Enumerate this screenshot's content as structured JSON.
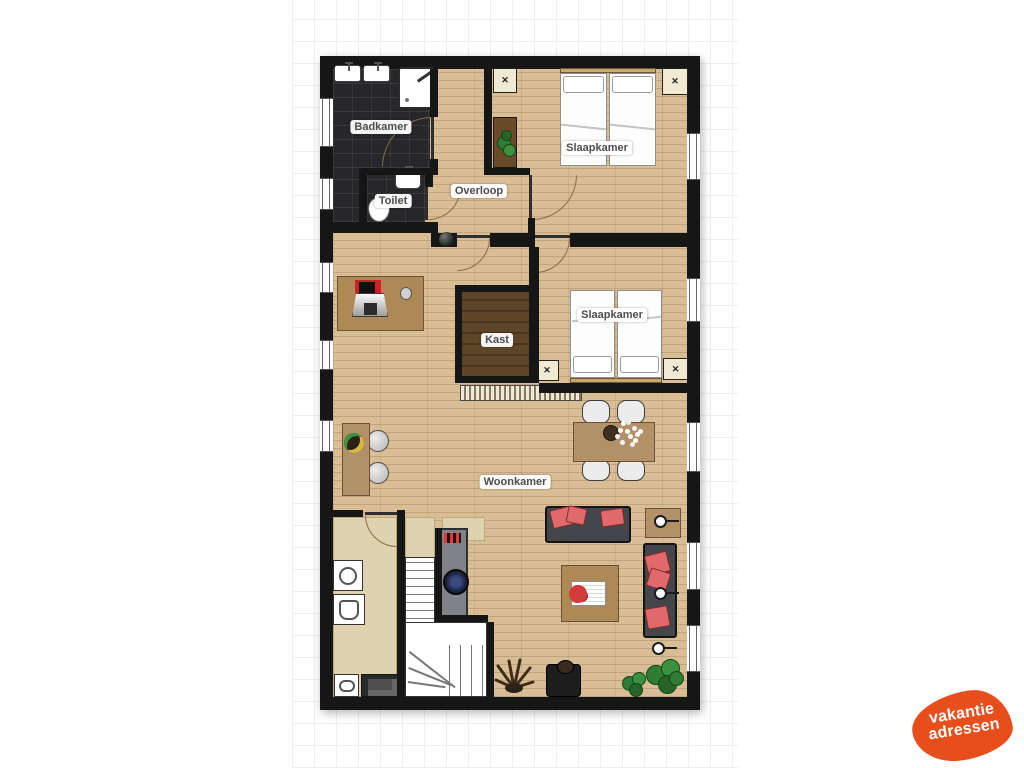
{
  "plan": {
    "type": "floorplan",
    "rooms": {
      "badkamer": "Badkamer",
      "toilet": "Toilet",
      "overloop": "Overloop",
      "slaapkamer_boven": "Slaapkamer",
      "slaapkamer_midden": "Slaapkamer",
      "kast": "Kast",
      "woonkamer": "Woonkamer"
    }
  },
  "logo": {
    "line1": "vakantie",
    "line2": "adressen",
    "bg_color": "#e84e1b",
    "text_color": "#ffffff"
  },
  "colors": {
    "wall": "#161616",
    "wood_floor": "#d9bd94",
    "tile_floor": "#26262b",
    "kitchen_floor": "#ded3ae",
    "kast_floor": "#5e4527",
    "pillow_accent": "#e2696b"
  }
}
